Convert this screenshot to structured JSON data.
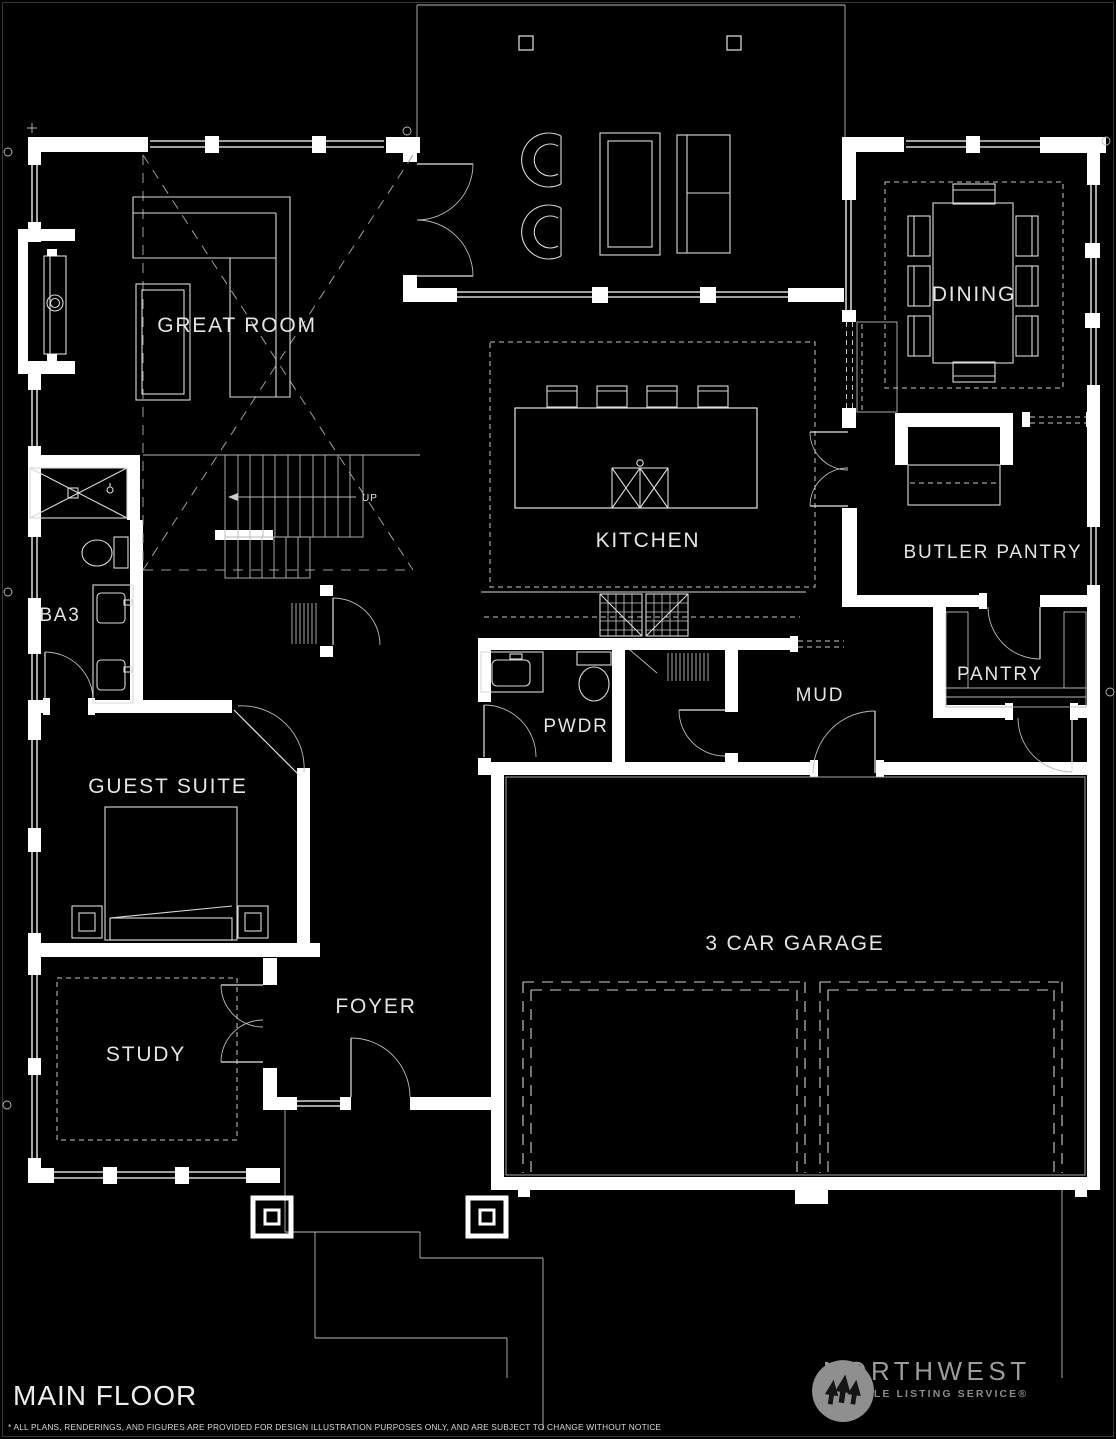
{
  "page": {
    "background": "#000000",
    "wall_color": "#ffffff",
    "line_color": "#e6e6e6"
  },
  "floor_plan": {
    "title": "MAIN FLOOR",
    "disclaimer": "* ALL PLANS, RENDERINGS, AND FIGURES ARE PROVIDED FOR DESIGN ILLUSTRATION PURPOSES ONLY, AND ARE SUBJECT TO CHANGE WITHOUT NOTICE",
    "rooms": {
      "great_room": "GREAT ROOM",
      "dining": "DINING",
      "kitchen": "KITCHEN",
      "butler_pantry": "BUTLER PANTRY",
      "pantry": "PANTRY",
      "mud": "MUD",
      "powder": "PWDR",
      "bath3": "BA3",
      "guest_suite": "GUEST SUITE",
      "study": "STUDY",
      "foyer": "FOYER",
      "garage": "3 CAR GARAGE",
      "stairs_direction": "UP"
    }
  },
  "logo": {
    "brand": "NORTHWEST",
    "tagline": "MULTIPLE LISTING SERVICE®",
    "icon": "three-pines-icon",
    "circle_color": "#8f8f8f",
    "text_color": "#9c9c9c"
  }
}
